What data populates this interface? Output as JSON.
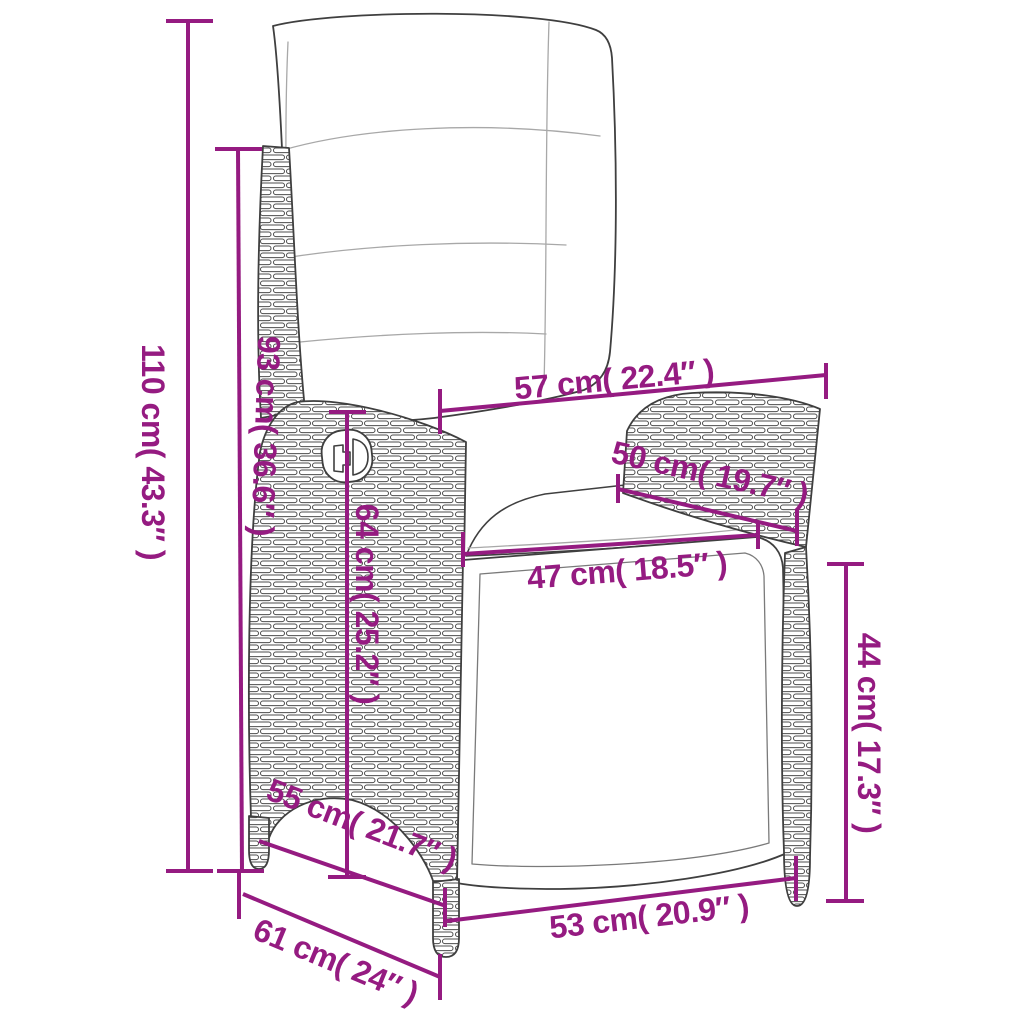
{
  "diagram": {
    "title": "reclining-garden-chair-dimension-diagram",
    "subject": "poly rattan reclining garden chair with cushions",
    "accent_color": "#951B81",
    "outline_color": "#3F3F3F",
    "background_color": "#FFFFFF",
    "dimensions": [
      {
        "name": "total-height",
        "label": "110 cm( 43.3″ )"
      },
      {
        "name": "backrest-height",
        "label": "93 cm( 36.6″ )"
      },
      {
        "name": "top-width",
        "label": "57 cm( 22.4″ )"
      },
      {
        "name": "armrest-length",
        "label": "50 cm( 19.7″ )"
      },
      {
        "name": "seat-width",
        "label": "47 cm( 18.5″ )"
      },
      {
        "name": "armrest-height",
        "label": "64 cm( 25.2″ )"
      },
      {
        "name": "seat-height",
        "label": "44 cm( 17.3″ )"
      },
      {
        "name": "seat-depth",
        "label": "55 cm( 21.7″ )"
      },
      {
        "name": "base-front-width",
        "label": "53 cm( 20.9″ )"
      },
      {
        "name": "base-side-depth",
        "label": "61 cm( 24″ )"
      }
    ]
  }
}
